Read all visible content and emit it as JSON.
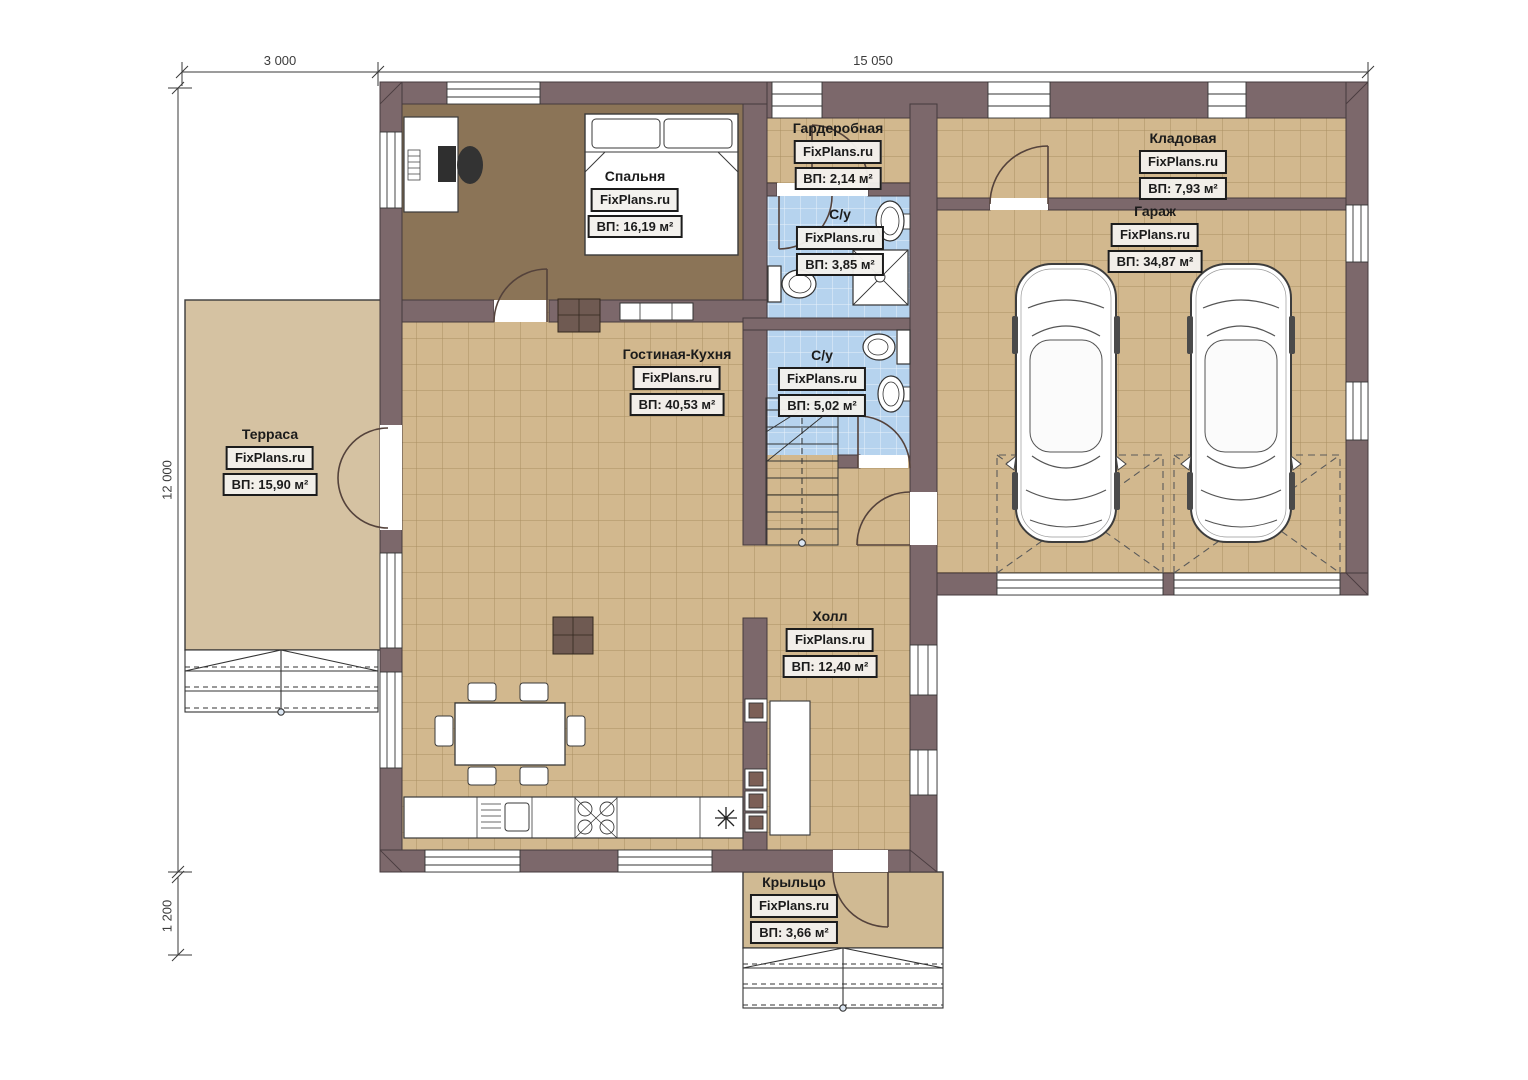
{
  "plan": {
    "title": "Floor plan (1st floor)",
    "dimensions": {
      "terrace_width": "3 000",
      "house_width": "15 050",
      "house_depth": "12 000",
      "porch_depth": "1 200"
    },
    "rooms": [
      {
        "id": "bedroom",
        "name": "Спальня",
        "brand": "FixPlans.ru",
        "area": "ВП: 16,19 м²"
      },
      {
        "id": "wardrobe",
        "name": "Гардеробная",
        "brand": "FixPlans.ru",
        "area": "ВП: 2,14 м²"
      },
      {
        "id": "bathroom-1",
        "name": "С/у",
        "brand": "FixPlans.ru",
        "area": "ВП: 3,85 м²"
      },
      {
        "id": "storage",
        "name": "Кладовая",
        "brand": "FixPlans.ru",
        "area": "ВП: 7,93 м²"
      },
      {
        "id": "garage",
        "name": "Гараж",
        "brand": "FixPlans.ru",
        "area": "ВП: 34,87 м²"
      },
      {
        "id": "living-kitchen",
        "name": "Гостиная-Кухня",
        "brand": "FixPlans.ru",
        "area": "ВП: 40,53 м²"
      },
      {
        "id": "bathroom-2",
        "name": "С/у",
        "brand": "FixPlans.ru",
        "area": "ВП: 5,02 м²"
      },
      {
        "id": "terrace",
        "name": "Терраса",
        "brand": "FixPlans.ru",
        "area": "ВП: 15,90 м²"
      },
      {
        "id": "hall",
        "name": "Холл",
        "brand": "FixPlans.ru",
        "area": "ВП: 12,40 м²"
      },
      {
        "id": "porch",
        "name": "Крыльцо",
        "brand": "FixPlans.ru",
        "area": "ВП: 3,66 м²"
      }
    ],
    "colors": {
      "wall": "#7c686b",
      "wall_outline": "#453a3c",
      "tile_floor": "#d2b88e",
      "tile_grid": "#aa8f62",
      "wood_floor": "#8b7457",
      "bath_tile": "#b6d3ee",
      "terrace_floor": "#d5c2a2",
      "porch_floor": "#d0ba93",
      "background": "#ffffff"
    }
  }
}
